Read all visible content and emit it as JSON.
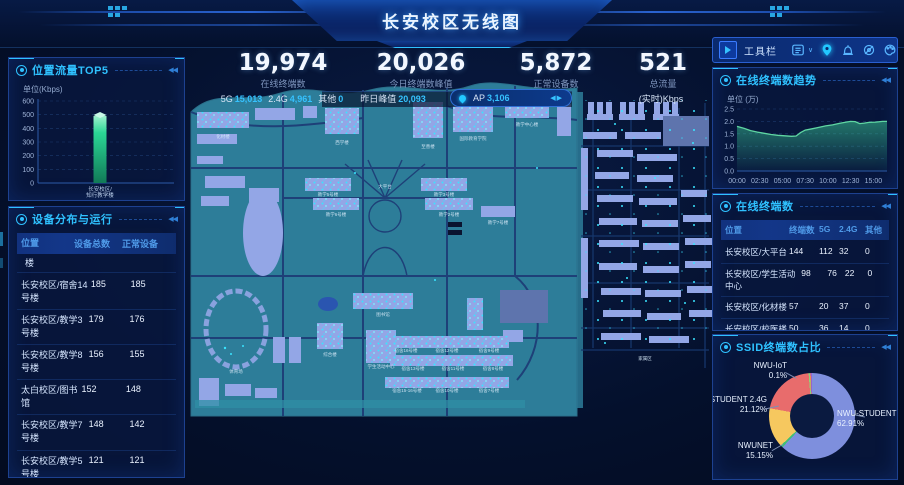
{
  "header": {
    "title": "长安校区无线图"
  },
  "toolbar": {
    "label": "工具栏",
    "icons": [
      "expand-arrow-icon",
      "list-filter-icon",
      "chevron-down-icon",
      "location-pin-icon",
      "alarm-icon",
      "eye-off-icon",
      "palette-icon"
    ]
  },
  "stats": [
    {
      "value": "19,974",
      "label": "在线终端数",
      "sub": [
        {
          "k": "5G",
          "v": "15,013"
        },
        {
          "k": "2.4G",
          "v": "4,961"
        },
        {
          "k": "其他",
          "v": "0"
        }
      ]
    },
    {
      "value": "20,026",
      "label": "今日终端数峰值",
      "sub": [
        {
          "k": "昨日峰值",
          "v": "20,093"
        }
      ]
    },
    {
      "value": "5,872",
      "label": "正常设备数",
      "sub": [
        {
          "k": "AP",
          "v": "3,106"
        }
      ]
    },
    {
      "value": "521",
      "label": "总流量",
      "sub": [
        {
          "k": "(实时)Kbps",
          "v": ""
        }
      ]
    }
  ],
  "panels": {
    "devices": {
      "title": "设备分布与运行",
      "columns": [
        "位置",
        "设备总数",
        "正常设备"
      ],
      "partial_top_row": "楼",
      "rows": [
        [
          "长安校区/宿舍14号楼",
          "185",
          "185"
        ],
        [
          "长安校区/教学3号楼",
          "179",
          "176"
        ],
        [
          "长安校区/教学8号楼",
          "156",
          "155"
        ],
        [
          "太白校区/图书馆",
          "152",
          "148"
        ],
        [
          "长安校区/教学7号楼",
          "148",
          "142"
        ],
        [
          "长安校区/教学5号楼",
          "121",
          "121"
        ]
      ]
    },
    "terminals": {
      "title": "在线终端数",
      "columns": [
        "位置",
        "终端数",
        "5G",
        "2.4G",
        "其他"
      ],
      "rows": [
        [
          "长安校区/大平台",
          "144",
          "112",
          "32",
          "0"
        ],
        [
          "长安校区/学生活动中心",
          "98",
          "76",
          "22",
          "0"
        ],
        [
          "长安校区/化材楼",
          "57",
          "20",
          "37",
          "0"
        ],
        [
          "长安校区/校医楼",
          "50",
          "36",
          "14",
          "0"
        ],
        [
          "长安校区/模拟法庭",
          "30",
          "21",
          "9",
          "0"
        ]
      ]
    }
  },
  "chart_data": [
    {
      "type": "bar",
      "title": "位置流量TOP5",
      "ylabel": "单位(Kbps)",
      "categories": [
        "长安校区/知行教学楼"
      ],
      "values": [
        490
      ],
      "ylim": [
        0,
        600
      ],
      "yticks": [
        0,
        100,
        200,
        300,
        400,
        500,
        600
      ],
      "bar_color": "#2ed39a",
      "grid": true,
      "legend": "none"
    },
    {
      "type": "area",
      "title": "在线终端数趋势",
      "ylabel": "单位 (万)",
      "ylim": [
        0,
        2.5
      ],
      "yticks": [
        0.0,
        0.5,
        1.0,
        1.5,
        2.0,
        2.5
      ],
      "xticks": [
        "00:00",
        "02:30",
        "05:00",
        "07:30",
        "10:00",
        "12:30",
        "15:00"
      ],
      "x_range_hours": [
        0,
        16.5
      ],
      "x_hours": [
        0,
        0.75,
        1.5,
        2.25,
        3,
        3.75,
        4.5,
        5.25,
        6,
        6.5,
        7,
        7.5,
        8.25,
        9,
        9.75,
        10.5,
        11.25,
        12,
        12.5,
        13,
        13.5,
        14,
        14.5,
        15.25,
        16,
        16.5
      ],
      "values": [
        1.8,
        1.72,
        1.63,
        1.57,
        1.52,
        1.47,
        1.44,
        1.42,
        1.4,
        1.41,
        1.55,
        1.65,
        1.7,
        1.76,
        1.82,
        1.86,
        1.92,
        1.97,
        2.0,
        1.99,
        1.91,
        1.93,
        1.96,
        1.97,
        2.0,
        2.0
      ],
      "line_color": "#5fd6a2",
      "grid": true
    },
    {
      "type": "pie",
      "title": "SSID终端数占比",
      "slices": [
        {
          "name": "NWU-STUDENT",
          "pct": "62.91%",
          "value": 62.91,
          "color": "#7e8fdd"
        },
        {
          "name": "",
          "pct": "",
          "value": 0.9,
          "color": "#3fbf77"
        },
        {
          "name": "NWUNET",
          "pct": "15.15%",
          "value": 15.15,
          "color": "#f6c85f"
        },
        {
          "name": "NWU-STUDENT 2.4G",
          "pct": "21.12%",
          "value": 21.12,
          "color": "#e86c6c"
        },
        {
          "name": "NWU-IoT",
          "pct": "0.1%",
          "value": 0.5,
          "color": "#8fd17a"
        },
        {
          "name": "",
          "pct": "",
          "value": 0.3,
          "color": "#f08a4b"
        },
        {
          "name": "",
          "pct": "",
          "value": 0.5,
          "color": "#9a63c9"
        }
      ],
      "legend": "callout-labels"
    }
  ],
  "map": {
    "labels": [
      {
        "t": "化材楼",
        "x": 38,
        "y": 90
      },
      {
        "t": "西学楼",
        "x": 157,
        "y": 96
      },
      {
        "t": "至善楼",
        "x": 243,
        "y": 100
      },
      {
        "t": "国际教育学院",
        "x": 288,
        "y": 92
      },
      {
        "t": "教学中心楼",
        "x": 342,
        "y": 78
      },
      {
        "t": "大平台",
        "x": 200,
        "y": 140
      },
      {
        "t": "教学5号楼",
        "x": 143,
        "y": 148
      },
      {
        "t": "教学6号楼",
        "x": 151,
        "y": 168
      },
      {
        "t": "教学3号楼",
        "x": 259,
        "y": 148
      },
      {
        "t": "教学2号楼",
        "x": 264,
        "y": 168
      },
      {
        "t": "教学7号楼",
        "x": 313,
        "y": 176
      },
      {
        "t": "综合楼",
        "x": 145,
        "y": 308
      },
      {
        "t": "图书馆",
        "x": 198,
        "y": 268
      },
      {
        "t": "学生活动中心",
        "x": 196,
        "y": 320
      },
      {
        "t": "体育场",
        "x": 51,
        "y": 325
      },
      {
        "t": "宿舍16号楼",
        "x": 221,
        "y": 304
      },
      {
        "t": "宿舍13号楼",
        "x": 228,
        "y": 322
      },
      {
        "t": "宿舍15-16号楼",
        "x": 222,
        "y": 344
      },
      {
        "t": "宿舍12号楼",
        "x": 262,
        "y": 304
      },
      {
        "t": "宿舍11号楼",
        "x": 268,
        "y": 322
      },
      {
        "t": "宿舍10号楼",
        "x": 262,
        "y": 344
      },
      {
        "t": "宿舍9号楼",
        "x": 304,
        "y": 304
      },
      {
        "t": "宿舍8号楼",
        "x": 308,
        "y": 322
      },
      {
        "t": "宿舍7号楼",
        "x": 304,
        "y": 344
      },
      {
        "t": "家属区",
        "x": 460,
        "y": 312
      }
    ]
  }
}
